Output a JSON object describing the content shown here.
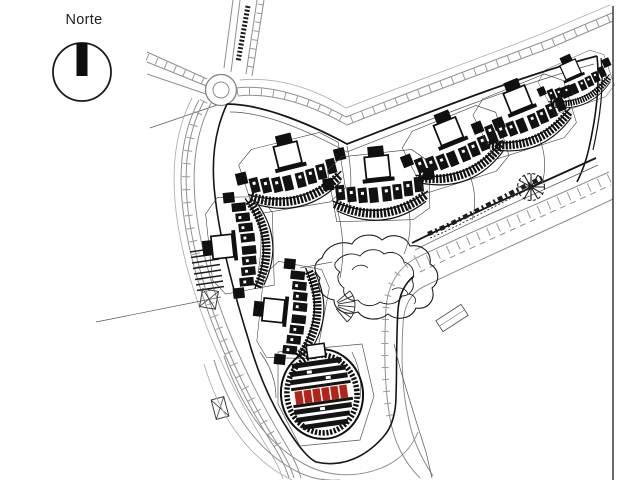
{
  "compass": {
    "label": "Norte"
  },
  "palette": {
    "paper": "#ffffff",
    "ink": "#161616",
    "road_gray": "#8f8f8f",
    "mid_gray": "#555555",
    "highlight_red": "#b22318"
  },
  "map": {
    "type": "architectural-site-plan",
    "clusters": [
      {
        "id": "building-cluster-a",
        "x": 294,
        "y": 180,
        "rot": -14,
        "scale": 1
      },
      {
        "id": "building-cluster-b",
        "x": 380,
        "y": 193,
        "rot": -6,
        "scale": 1
      },
      {
        "id": "building-cluster-c",
        "x": 458,
        "y": 155,
        "rot": -22,
        "scale": 0.98
      },
      {
        "id": "building-cluster-d",
        "x": 527,
        "y": 122,
        "rot": -22,
        "scale": 0.95
      },
      {
        "id": "building-cluster-e",
        "x": 578,
        "y": 86,
        "rot": -24,
        "scale": 0.7
      },
      {
        "id": "building-cluster-f",
        "x": 247,
        "y": 244,
        "rot": -96,
        "scale": 0.95
      },
      {
        "id": "building-cluster-g",
        "x": 298,
        "y": 313,
        "rot": -84,
        "scale": 0.95
      }
    ],
    "highlighted_building": {
      "id": "building-cluster-h-highlighted",
      "x": 322,
      "y": 394,
      "rot": -8,
      "scale": 1,
      "highlight_color": "#b22318"
    }
  }
}
